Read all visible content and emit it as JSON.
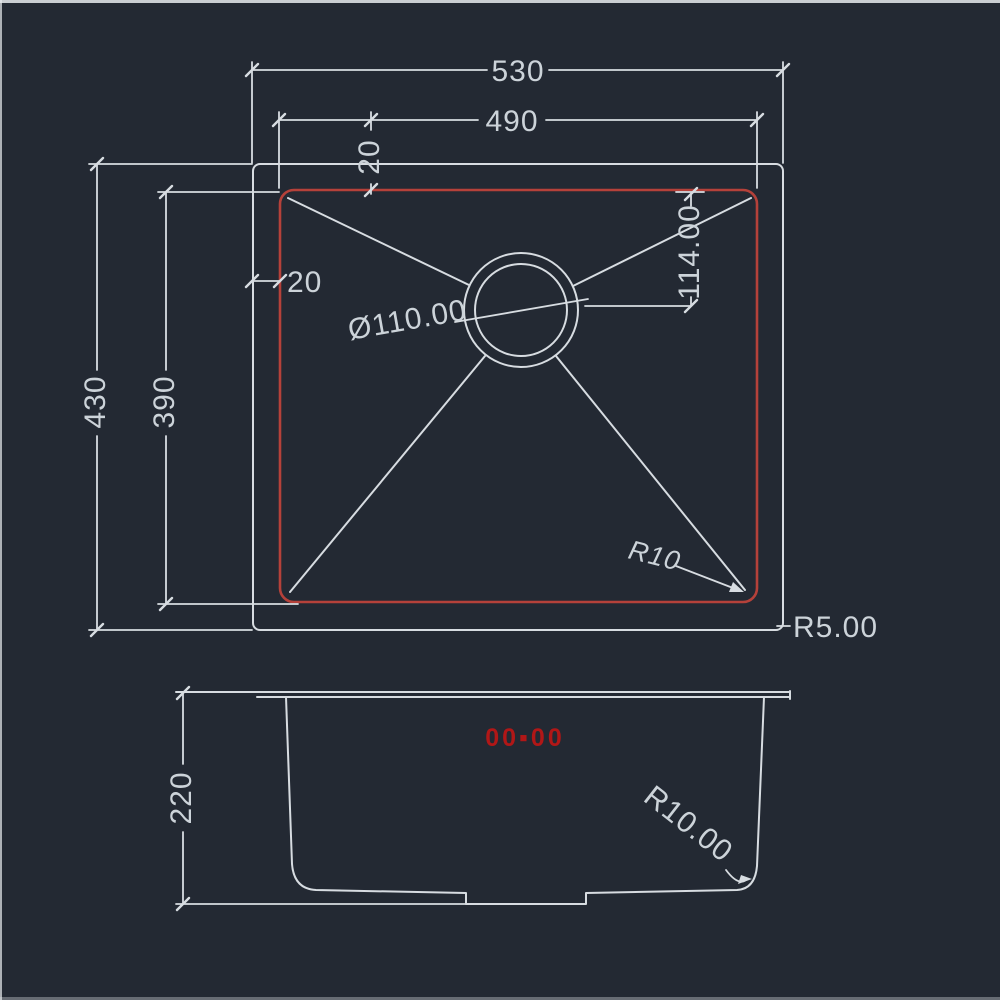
{
  "colors": {
    "background": "#232933",
    "line": "#d7dce1",
    "dim_text": "#ccd3d9",
    "red_line": "#b5413a",
    "red_text": "#b11717"
  },
  "top_view": {
    "overall_width": "530",
    "bowl_width": "490",
    "rim_top_offset": "20",
    "rim_left_offset": "20",
    "overall_depth": "430",
    "bowl_depth": "390",
    "drain_offset": "114.00",
    "drain_diameter": "Ø110.00",
    "bowl_corner_radius": "R10",
    "outer_corner_radius": "R5.00"
  },
  "side_view": {
    "bowl_height": "220",
    "bottom_corner_radius": "R10.00",
    "red_marking": "00▪00"
  }
}
